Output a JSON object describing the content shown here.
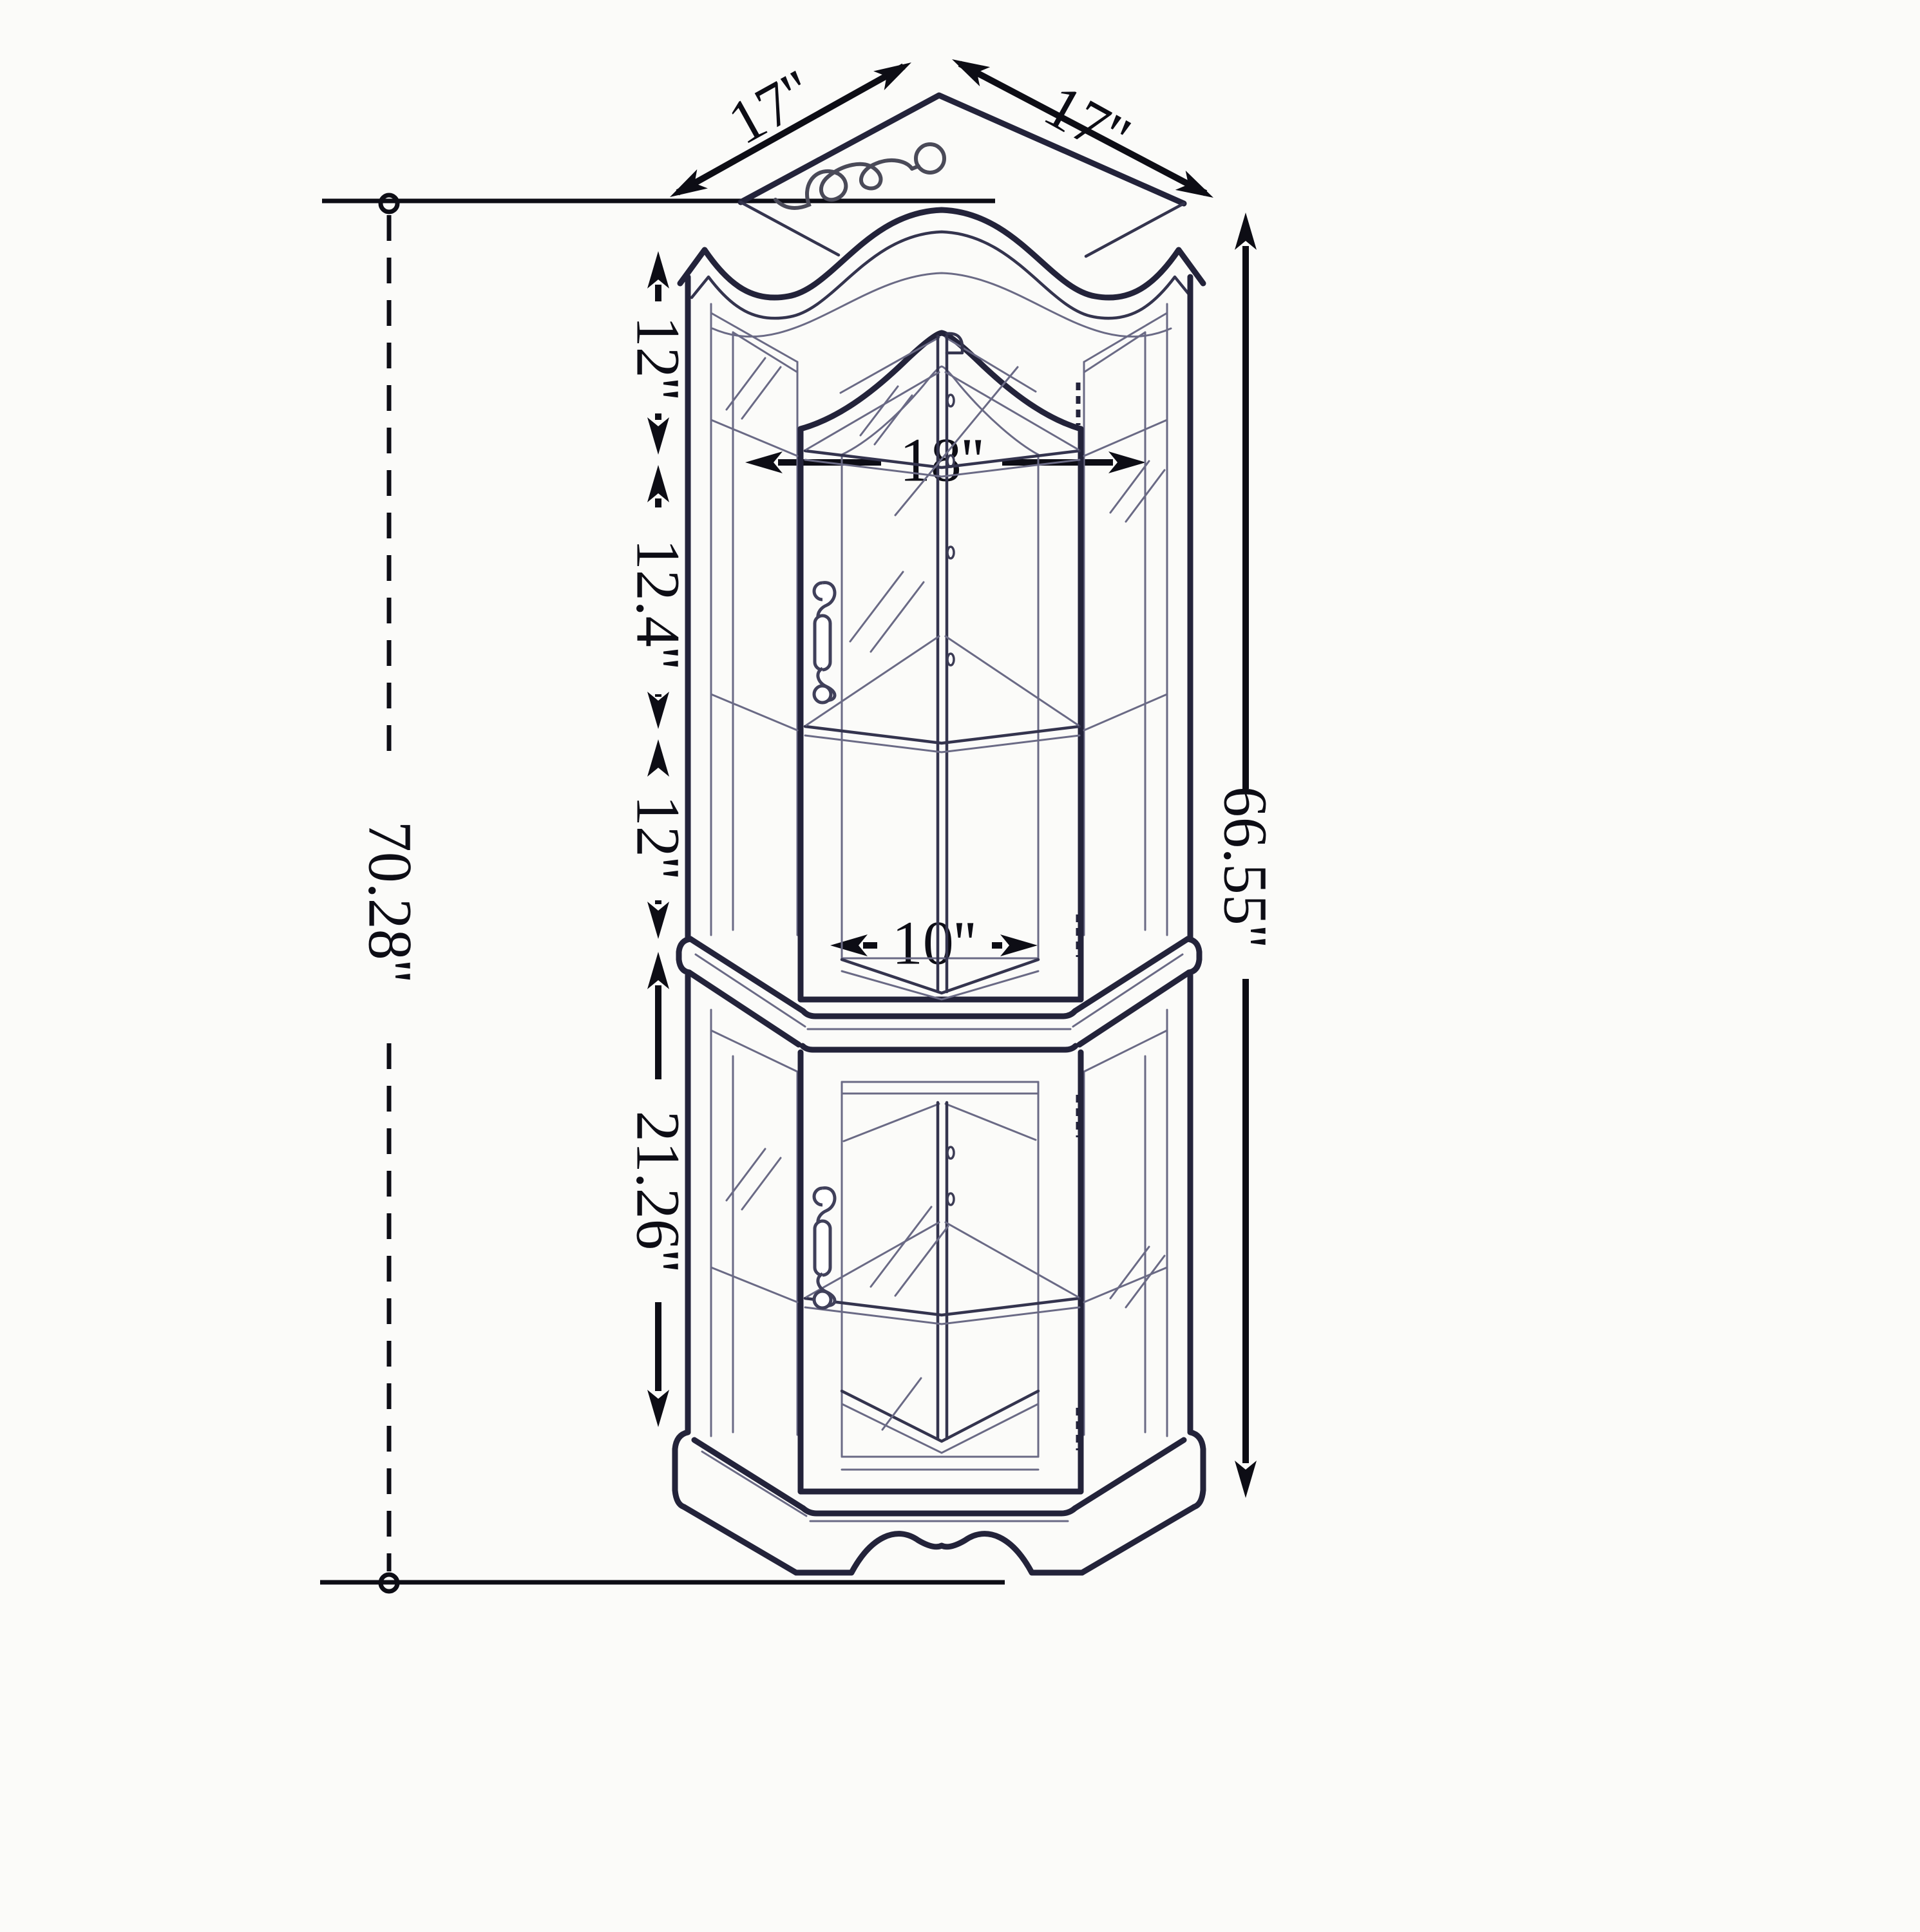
{
  "diagram": {
    "type": "furniture-dimension-drawing",
    "subject": "corner curio display cabinet with two glass doors",
    "units": "inches",
    "colors": {
      "background": "#fbfbf9",
      "line": "#23233a",
      "line2": "#34344e",
      "line3": "#6a6a85",
      "dim": "#0d0d15"
    },
    "dimensions": {
      "top_depth_left": "17''",
      "top_depth_right": "17''",
      "upper_shelf_top": "12''",
      "upper_width": "18''",
      "upper_shelf_middle": "12.4''",
      "upper_shelf_bottom": "12''",
      "lower_door_width": "10''",
      "lower_section_height": "21.26''",
      "cabinet_height": "66.55''",
      "overall_height": "70.28''"
    }
  }
}
